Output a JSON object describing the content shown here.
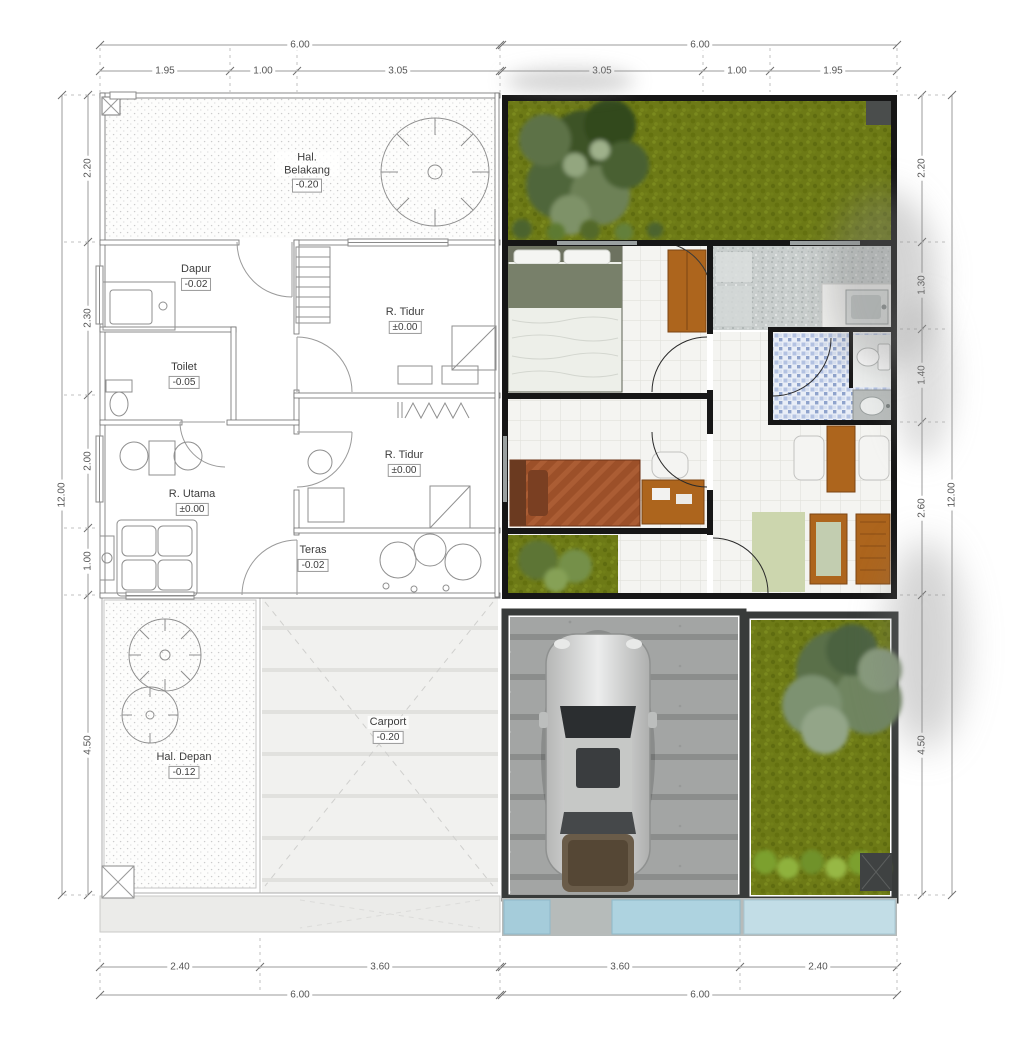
{
  "dimensions": {
    "top": {
      "overall_left": "6.00",
      "overall_right": "6.00",
      "left_segments": [
        "1.95",
        "1.00",
        "3.05"
      ],
      "right_segments": [
        "3.05",
        "1.00",
        "1.95"
      ]
    },
    "bottom": {
      "overall_left": "6.00",
      "overall_right": "6.00",
      "left_segments": [
        "2.40",
        "3.60"
      ],
      "right_segments": [
        "3.60",
        "2.40"
      ]
    },
    "left": {
      "overall": "12.00",
      "segments": [
        "2.20",
        "2.30",
        "2.00",
        "1.00",
        "4.50"
      ]
    },
    "right": {
      "overall": "12.00",
      "segments": [
        "2.20",
        "1.30",
        "1.40",
        "2.60",
        "4.50"
      ]
    }
  },
  "rooms": {
    "hal_belakang": {
      "name": "Hal. Belakang",
      "elevation": "-0.20"
    },
    "dapur": {
      "name": "Dapur",
      "elevation": "-0.02"
    },
    "r_tidur_1": {
      "name": "R. Tidur",
      "elevation": "±0.00"
    },
    "toilet": {
      "name": "Toilet",
      "elevation": "-0.05"
    },
    "r_utama": {
      "name": "R. Utama",
      "elevation": "±0.00"
    },
    "r_tidur_2": {
      "name": "R. Tidur",
      "elevation": "±0.00"
    },
    "teras": {
      "name": "Teras",
      "elevation": "-0.02"
    },
    "hal_depan": {
      "name": "Hal. Depan",
      "elevation": "-0.12"
    },
    "carport": {
      "name": "Carport",
      "elevation": "-0.20"
    }
  },
  "objects": [
    "tree",
    "shrub",
    "lawn",
    "bed",
    "wardrobe",
    "kitchen-sink",
    "kitchen-counter",
    "toilet-bowl",
    "washbasin",
    "dining-table",
    "dining-chair",
    "lounge-chair",
    "rug",
    "desk",
    "desk-chair",
    "car",
    "paving",
    "water-tiles"
  ],
  "theme": {
    "wall_black": "#161616",
    "sketch_line": "#8f8f8f",
    "dim_line": "#9b9b9b",
    "grass": "#6d7a16",
    "tree_dark": "#3c5226",
    "tree_light": "#93a67f",
    "tile": "#f4f4f1",
    "pebble": "#c9cecd",
    "mosaic_blue": "#b3c2e2",
    "concrete": "#a3a5a4",
    "car_silver": "#d6d7d6",
    "wood": "#ad651d",
    "rust_bed": "#9c5029",
    "rug_green": "#ccd6ae",
    "water_blue": "#a8cfdd",
    "text": "#3c3c3c"
  }
}
